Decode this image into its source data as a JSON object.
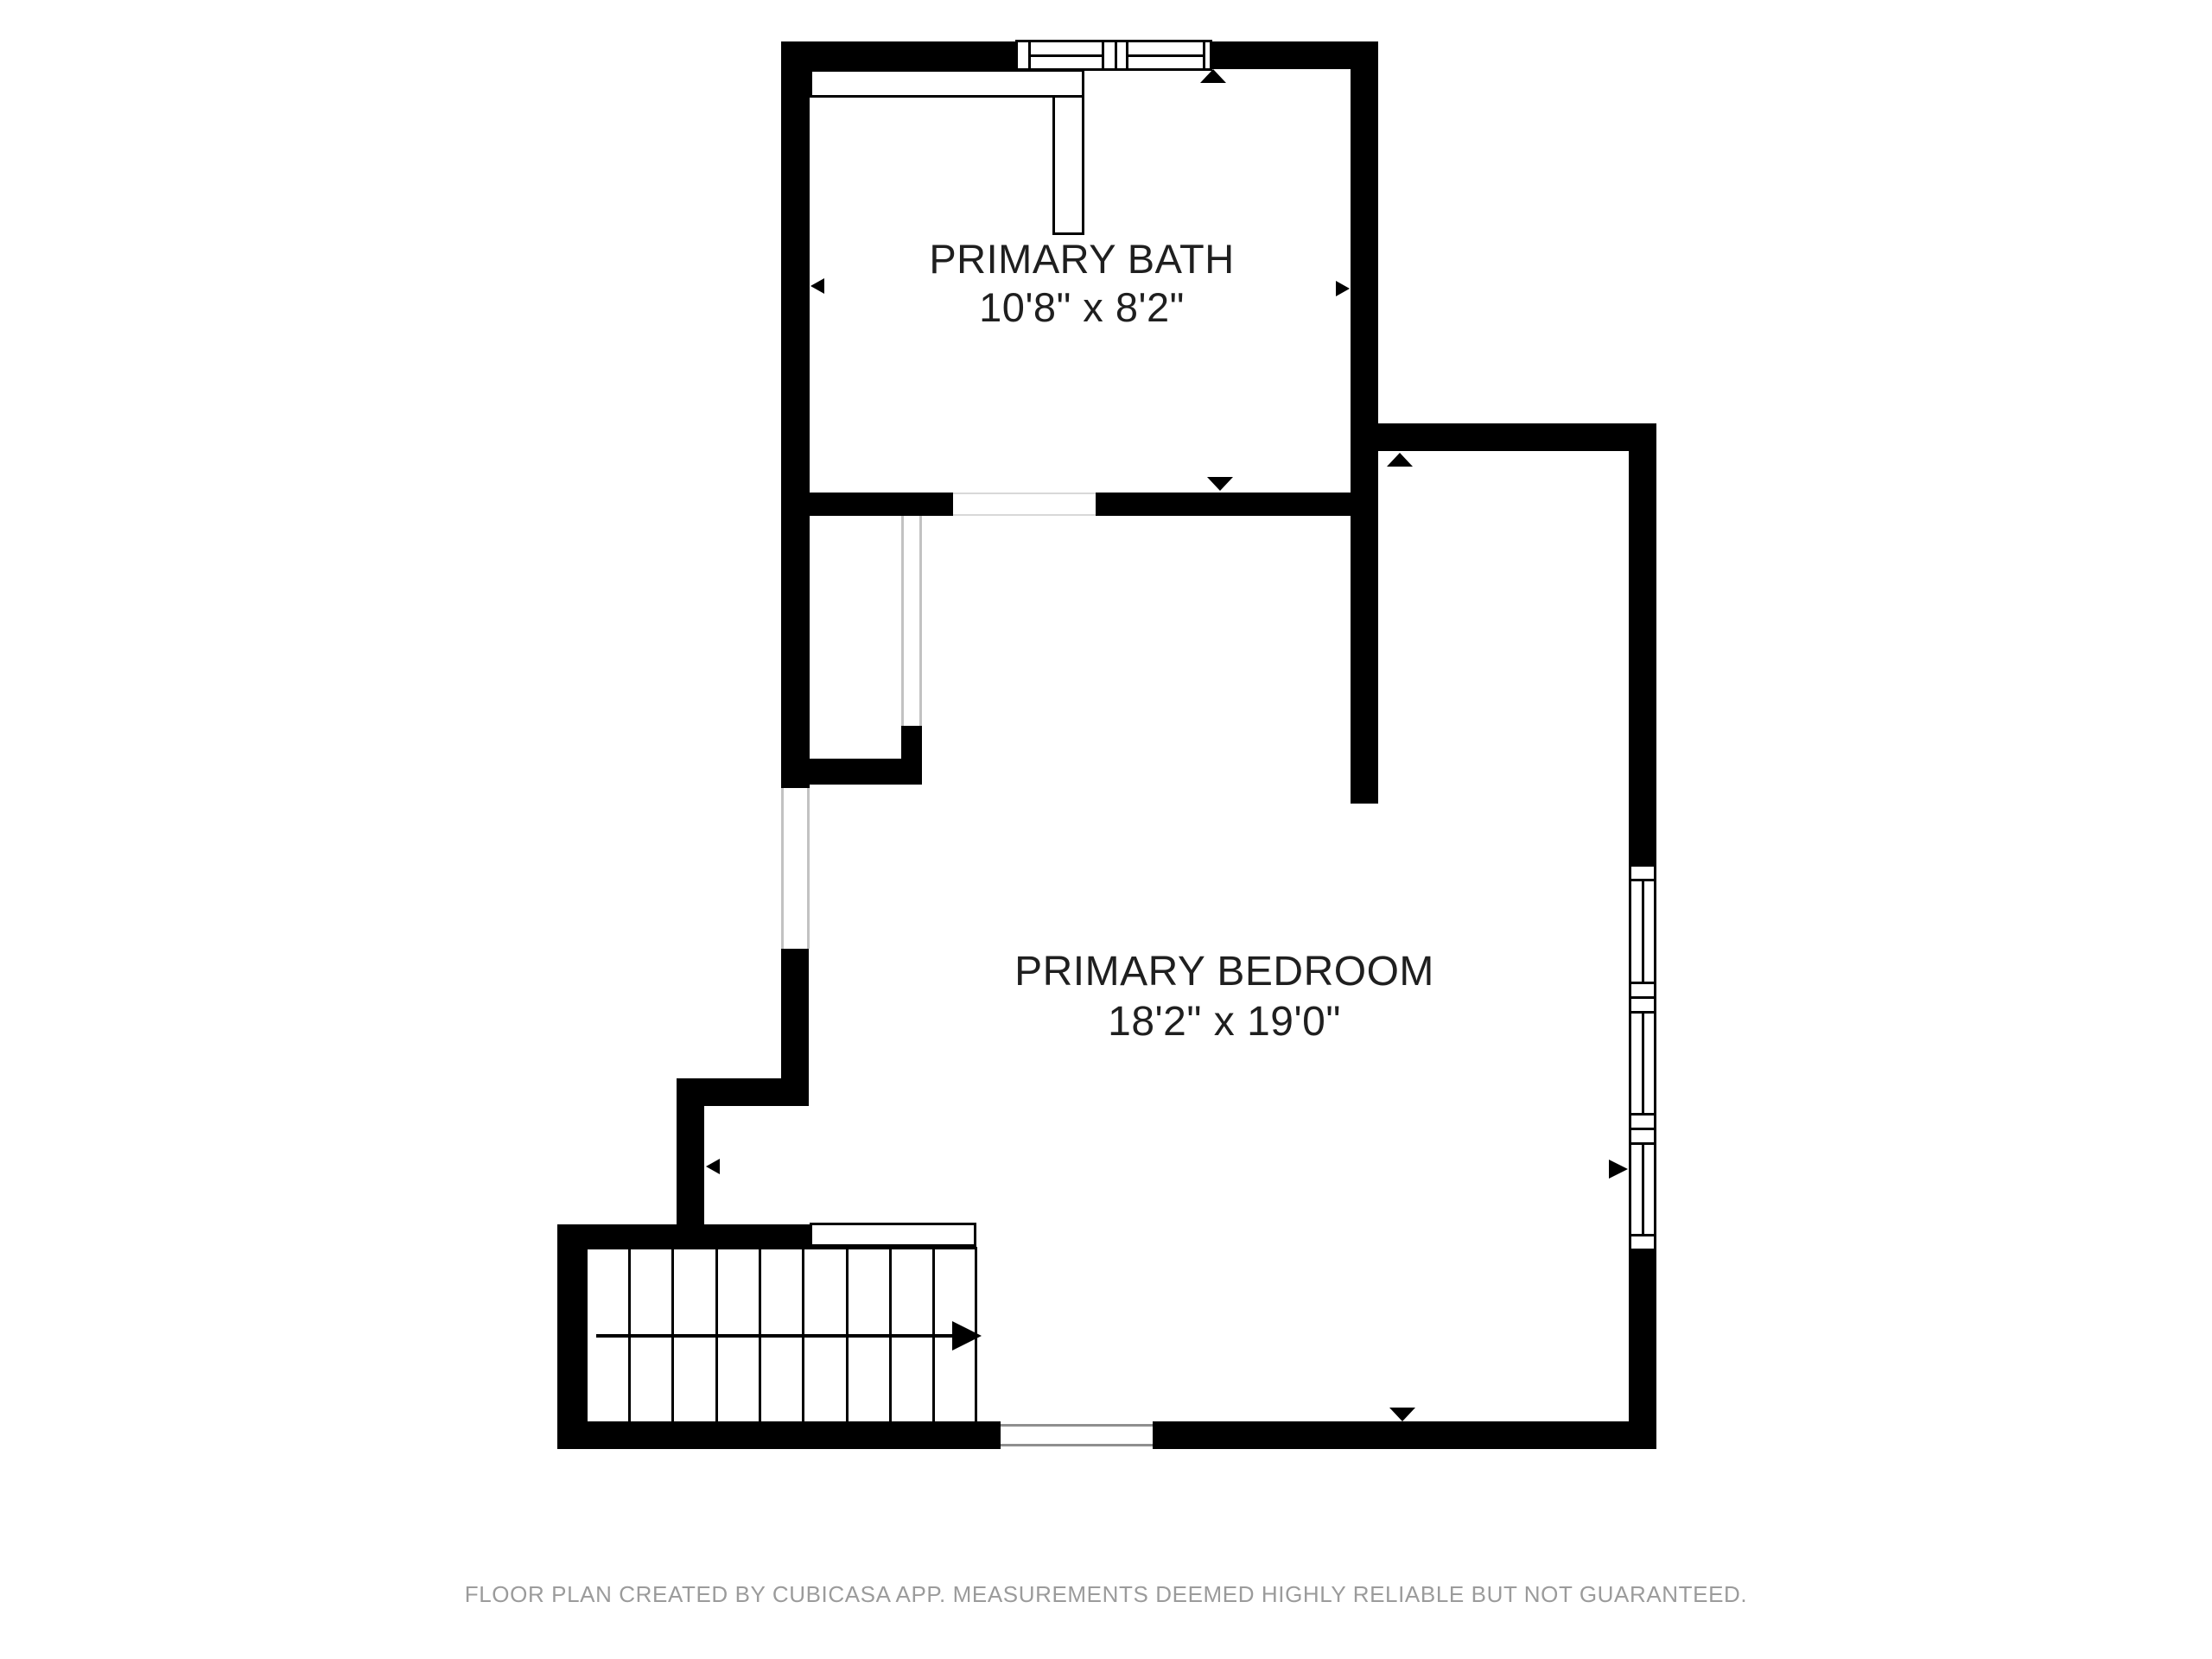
{
  "floor_plan": {
    "rooms": [
      {
        "name": "PRIMARY BATH",
        "dimensions": "10'8\" x 8'2\""
      },
      {
        "name": "PRIMARY BEDROOM",
        "dimensions": "18'2\" x 19'0\""
      }
    ],
    "footer": "FLOOR PLAN CREATED BY CUBICASA APP. MEASUREMENTS DEEMED HIGHLY RELIABLE BUT NOT GUARANTEED.",
    "colors": {
      "wall": "#000000",
      "room_text": "#1f1f1f",
      "footer_text": "#9b9b9b",
      "background": "#ffffff",
      "opening_line": "#c2c2c2"
    },
    "symbols": {
      "windows": [
        "top-wall-double-window",
        "right-wall-triple-window"
      ],
      "stairs": "straight-run-9-treads-arrow-right",
      "direction_arrows": [
        "up",
        "down",
        "left",
        "right"
      ]
    }
  }
}
